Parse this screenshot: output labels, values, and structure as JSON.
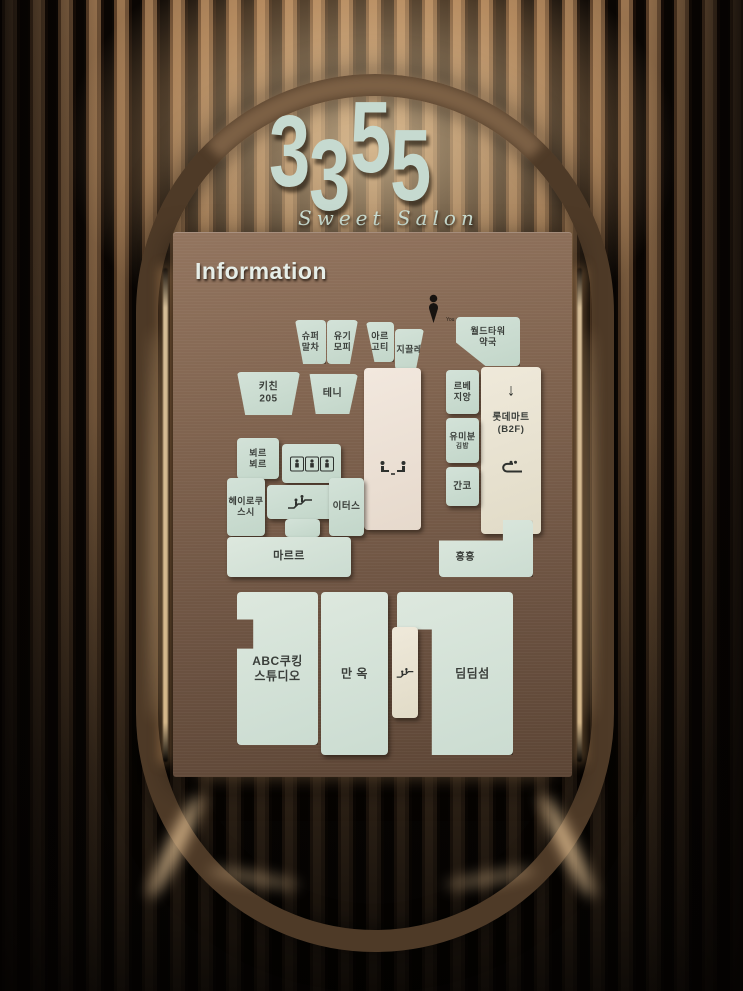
{
  "scene": {
    "logo_digits": [
      "3",
      "3",
      "5",
      "5"
    ],
    "logo_number": "3355",
    "logo_subtitle": "Sweet Salon"
  },
  "colors": {
    "logo_mint": "#c9dcd2",
    "panel_bronze": "#7a5f4c",
    "block_mint": "#cddcd2",
    "block_cream": "#e9e3d2",
    "led_warm": "#ffdca6",
    "label_ink": "#3a3e3a"
  },
  "map": {
    "panel_title": "Information",
    "marker": {
      "icon": "person-marker",
      "label": "You are here!"
    },
    "blocks": [
      {
        "name": "store-super-matcha",
        "lines": [
          "슈퍼",
          "말차"
        ],
        "x": 122,
        "y": 88,
        "w": 31,
        "h": 44,
        "fill": "mint",
        "clip": "polygon(0% 0%, 100% 0%, 100% 100%, 26% 100%)",
        "size": 9
      },
      {
        "name": "store-yugi-mopi",
        "lines": [
          "유기",
          "모피"
        ],
        "x": 154,
        "y": 88,
        "w": 31,
        "h": 44,
        "fill": "mint",
        "clip": "polygon(0% 0%, 100% 0%, 74% 100%, 0% 100%)",
        "size": 9
      },
      {
        "name": "store-areu-goti",
        "lines": [
          "아르",
          "고티"
        ],
        "x": 193,
        "y": 90,
        "w": 28,
        "h": 40,
        "fill": "mint",
        "clip": "polygon(0% 0%, 100% 0%, 100% 100%, 30% 100%)",
        "size": 9
      },
      {
        "name": "store-giclee",
        "lines": [
          "지끌레"
        ],
        "x": 222,
        "y": 97,
        "w": 29,
        "h": 41,
        "fill": "mint",
        "clip": "polygon(0% 0%, 100% 0%, 72% 100%, 0% 100%)",
        "size": 9
      },
      {
        "name": "store-world-tower-pharmacy",
        "lines": [
          "월드타워",
          "약국"
        ],
        "x": 283,
        "y": 85,
        "w": 64,
        "h": 49,
        "fill": "mint",
        "clip": "polygon(0% 0%, 100% 0%, 100% 100%, 46% 100%, 0% 52%)",
        "size": 9,
        "label_y": 40
      },
      {
        "name": "store-kitchen-205",
        "lines": [
          "키친",
          "205"
        ],
        "x": 64,
        "y": 140,
        "w": 63,
        "h": 43,
        "fill": "mint",
        "clip": "polygon(0% 0%, 100% 0%, 87% 100%, 13% 100%)",
        "size": 10
      },
      {
        "name": "store-teni",
        "lines": [
          "테니"
        ],
        "x": 134,
        "y": 142,
        "w": 51,
        "h": 40,
        "fill": "mint",
        "clip": "polygon(5% 0%, 100% 0%, 83% 100%, 17% 100%)",
        "size": 10
      },
      {
        "name": "store-le-be-jiang",
        "lines": [
          "르베",
          "지앙"
        ],
        "x": 273,
        "y": 138,
        "w": 33,
        "h": 44,
        "fill": "mint",
        "size": 9
      },
      {
        "name": "store-lotte-mart",
        "lines": [
          "롯데마트",
          "(B2F)"
        ],
        "x": 308,
        "y": 135,
        "w": 60,
        "h": 167,
        "fill": "cream",
        "icon": "down-arrow",
        "icon_y": 14,
        "label_y": 34,
        "icon2": "escalator-u",
        "icon2_y": 60,
        "size": 9.5
      },
      {
        "name": "corridor-hall",
        "x": 191,
        "y": 136,
        "w": 57,
        "h": 162,
        "fill": "blush",
        "icon": "facing-seats",
        "icon_y": 62
      },
      {
        "name": "store-yumibun-gimbap",
        "lines": [
          "유미분",
          {
            "t": "김밥",
            "small": true
          }
        ],
        "x": 273,
        "y": 186,
        "w": 33,
        "h": 45,
        "fill": "mint",
        "size": 9
      },
      {
        "name": "store-beurre-beurre",
        "lines": [
          "뵈르",
          "뵈르"
        ],
        "x": 64,
        "y": 206,
        "w": 42,
        "h": 41,
        "fill": "mint",
        "size": 9
      },
      {
        "name": "elevator-bank",
        "x": 109,
        "y": 212,
        "w": 59,
        "h": 39,
        "fill": "mint",
        "icon": "elevators",
        "icon_y": 50
      },
      {
        "name": "store-ganko",
        "lines": [
          "간코"
        ],
        "x": 273,
        "y": 235,
        "w": 33,
        "h": 39,
        "fill": "mint",
        "size": 9.5
      },
      {
        "name": "store-heiroku-sushi",
        "lines": [
          "헤이로쿠",
          "스시"
        ],
        "x": 54,
        "y": 246,
        "w": 38,
        "h": 58,
        "fill": "mint",
        "size": 9
      },
      {
        "name": "escalator-block",
        "x": 94,
        "y": 253,
        "w": 66,
        "h": 34,
        "fill": "mint",
        "icon": "escalator-up",
        "icon_y": 50
      },
      {
        "name": "escalator-block-stub",
        "x": 112,
        "y": 287,
        "w": 35,
        "h": 18,
        "fill": "mint"
      },
      {
        "name": "store-eaters",
        "lines": [
          "이터스"
        ],
        "x": 156,
        "y": 246,
        "w": 35,
        "h": 58,
        "fill": "mint",
        "size": 9.5
      },
      {
        "name": "store-mareuleu",
        "lines": [
          "마르르"
        ],
        "x": 54,
        "y": 305,
        "w": 124,
        "h": 40,
        "fill": "mint2",
        "size": 11
      },
      {
        "name": "store-hong-hong",
        "lines": [
          "홍홍"
        ],
        "x": 266,
        "y": 288,
        "w": 94,
        "h": 57,
        "fill": "mint2",
        "clip": "polygon(0% 36%, 68% 36%, 68% 0%, 100% 0%, 100% 100%, 0% 100%)",
        "label_x": 28,
        "label_y": 66,
        "size": 10
      },
      {
        "name": "store-abc-cooking-studio",
        "lines": [
          "ABC쿠킹",
          "스튜디오"
        ],
        "x": 64,
        "y": 360,
        "w": 81,
        "h": 153,
        "fill": "mint2",
        "clip": "polygon(0% 0%, 100% 0%, 100% 100%, 0% 100%, 0% 37%, 20% 37%, 20% 18%, 0% 18%)",
        "size": 12
      },
      {
        "name": "store-manok",
        "lines": [
          "만 옥"
        ],
        "x": 148,
        "y": 360,
        "w": 67,
        "h": 163,
        "fill": "mint2",
        "size": 12
      },
      {
        "name": "store-dimdimsum",
        "lines": [
          "딤딤섬"
        ],
        "x": 224,
        "y": 360,
        "w": 116,
        "h": 163,
        "fill": "mint2",
        "clip": "polygon(0% 0%, 100% 0%, 100% 100%, 30% 100%, 30% 23%, 0% 23%)",
        "label_x": 65,
        "size": 12
      },
      {
        "name": "escalator-strip",
        "x": 219,
        "y": 395,
        "w": 26,
        "h": 91,
        "fill": "cream",
        "icon": "escalator-small",
        "icon_y": 50
      }
    ]
  }
}
